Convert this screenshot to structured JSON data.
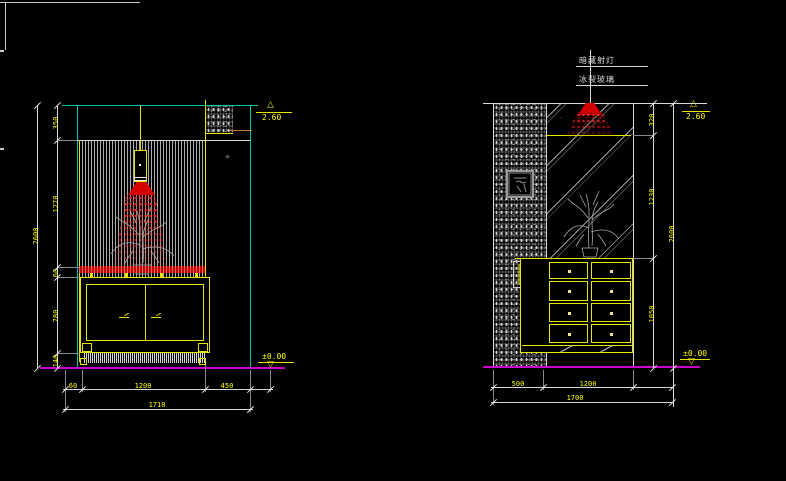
{
  "drawing": {
    "kind": "cad-interior-elevations",
    "background": "#000000"
  },
  "labels": {
    "spotlight": "暗藏射灯",
    "glass": "冰裂玻璃"
  },
  "left_elevation": {
    "level_top": "2.60",
    "level_floor": "±0.00",
    "dim_vertical_overall": "2600",
    "dim_vertical_segments": [
      "350",
      "1270",
      "60",
      "780",
      "140"
    ],
    "dim_bottom_segments": [
      "60",
      "1200",
      "450"
    ],
    "dim_bottom_overall": "1710"
  },
  "right_elevation": {
    "level_top": "2.60",
    "level_floor": "±0.00",
    "dim_vertical_overall": "2600",
    "dim_vertical_segments": [
      "320",
      "1230",
      "1050"
    ],
    "dim_bottom_segments": [
      "500",
      "1200"
    ],
    "dim_bottom_overall": "1700"
  },
  "colors": {
    "ceiling_line": "#00c8b4",
    "furniture_line": "#e6e600",
    "accent_red": "#d40000",
    "floor_line": "#cc00cc",
    "dim_line": "#d9d9d9"
  }
}
